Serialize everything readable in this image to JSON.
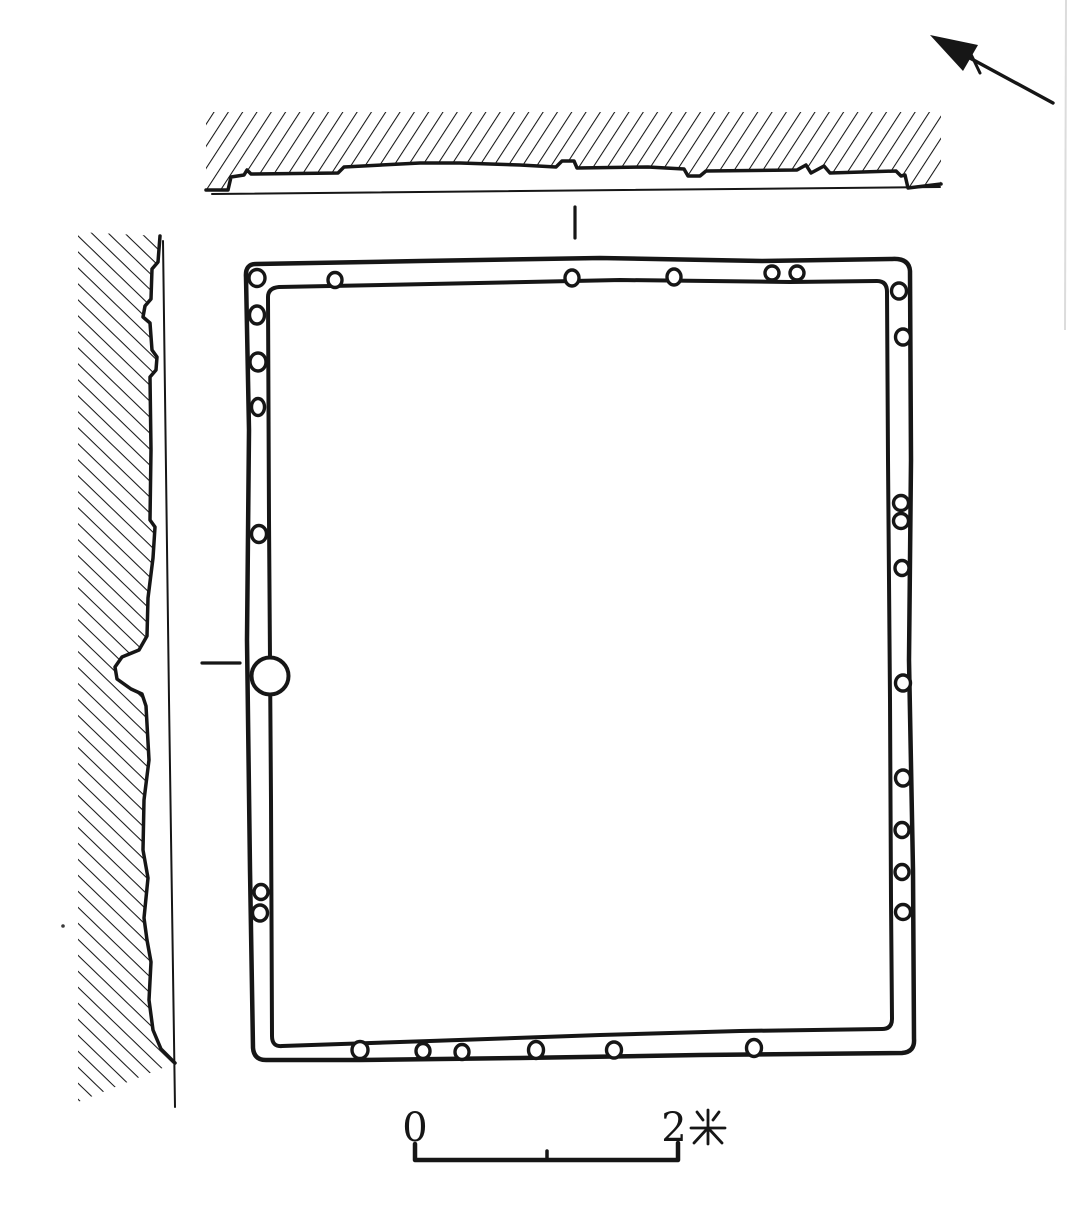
{
  "meta": {
    "type": "archaeological-plan-with-wall-sections",
    "drawing_style": "black ink line drawing"
  },
  "palette": {
    "ink": "#161616",
    "paper": "#ffffff",
    "page_edge": "#dcdcdc"
  },
  "north_arrow": {
    "icon": "north-arrow-icon",
    "direction": "upper-left"
  },
  "sections": {
    "top": {
      "hatch": "/",
      "icon": "hatched-section-band"
    },
    "left": {
      "hatch": "\\",
      "icon": "hatched-section-band"
    }
  },
  "plan": {
    "shape": "rounded-rectangle double-line wall",
    "doorway_circle": {
      "cx": 270,
      "cy": 676,
      "r": 18.5
    },
    "posthole_style": {
      "rx": 7.5,
      "ry": 8
    },
    "posthole_count": 28,
    "postholes": [
      {
        "wall": "top",
        "cx": 257,
        "cy": 278,
        "rx": 8,
        "ry": 8.5
      },
      {
        "wall": "top",
        "cx": 335,
        "cy": 280,
        "rx": 7,
        "ry": 7.5
      },
      {
        "wall": "top",
        "cx": 572,
        "cy": 278,
        "rx": 7,
        "ry": 8
      },
      {
        "wall": "top",
        "cx": 674,
        "cy": 277,
        "rx": 7,
        "ry": 8
      },
      {
        "wall": "top",
        "cx": 772,
        "cy": 273,
        "rx": 7,
        "ry": 7
      },
      {
        "wall": "top",
        "cx": 797,
        "cy": 273,
        "rx": 7,
        "ry": 7
      },
      {
        "wall": "right",
        "cx": 899,
        "cy": 291,
        "rx": 7.5,
        "ry": 8
      },
      {
        "wall": "right",
        "cx": 903,
        "cy": 337,
        "rx": 7.5,
        "ry": 8
      },
      {
        "wall": "right",
        "cx": 901,
        "cy": 503,
        "rx": 7.5,
        "ry": 7.5
      },
      {
        "wall": "right",
        "cx": 901,
        "cy": 521,
        "rx": 7.5,
        "ry": 7.5
      },
      {
        "wall": "right",
        "cx": 902,
        "cy": 568,
        "rx": 7,
        "ry": 7.5
      },
      {
        "wall": "right",
        "cx": 903,
        "cy": 683,
        "rx": 7.5,
        "ry": 8
      },
      {
        "wall": "right",
        "cx": 903,
        "cy": 778,
        "rx": 7.5,
        "ry": 8
      },
      {
        "wall": "right",
        "cx": 902,
        "cy": 830,
        "rx": 7,
        "ry": 7.5
      },
      {
        "wall": "right",
        "cx": 902,
        "cy": 872,
        "rx": 7,
        "ry": 7.5
      },
      {
        "wall": "right",
        "cx": 903,
        "cy": 912,
        "rx": 7.5,
        "ry": 7.5
      },
      {
        "wall": "bottom",
        "cx": 360,
        "cy": 1050,
        "rx": 8,
        "ry": 8.5
      },
      {
        "wall": "bottom",
        "cx": 423,
        "cy": 1051,
        "rx": 7,
        "ry": 7.5
      },
      {
        "wall": "bottom",
        "cx": 462,
        "cy": 1052,
        "rx": 7,
        "ry": 7.5
      },
      {
        "wall": "bottom",
        "cx": 536,
        "cy": 1050,
        "rx": 7.5,
        "ry": 8.5
      },
      {
        "wall": "bottom",
        "cx": 614,
        "cy": 1050,
        "rx": 7.5,
        "ry": 8
      },
      {
        "wall": "bottom",
        "cx": 754,
        "cy": 1048,
        "rx": 7.5,
        "ry": 8.5
      },
      {
        "wall": "left",
        "cx": 257,
        "cy": 315,
        "rx": 7.5,
        "ry": 9
      },
      {
        "wall": "left",
        "cx": 258,
        "cy": 362,
        "rx": 8,
        "ry": 9
      },
      {
        "wall": "left",
        "cx": 258,
        "cy": 407,
        "rx": 6.5,
        "ry": 8.5
      },
      {
        "wall": "left",
        "cx": 259,
        "cy": 534,
        "rx": 7.5,
        "ry": 8.5
      },
      {
        "wall": "left",
        "cx": 261,
        "cy": 892,
        "rx": 7,
        "ry": 7.5
      },
      {
        "wall": "left",
        "cx": 260,
        "cy": 913,
        "rx": 7.5,
        "ry": 8
      }
    ]
  },
  "scale_bar": {
    "left_label": "0",
    "right_value": "2",
    "unit": "米",
    "right_label": "2米",
    "span_px": [
      415,
      678
    ],
    "meters": 2
  }
}
